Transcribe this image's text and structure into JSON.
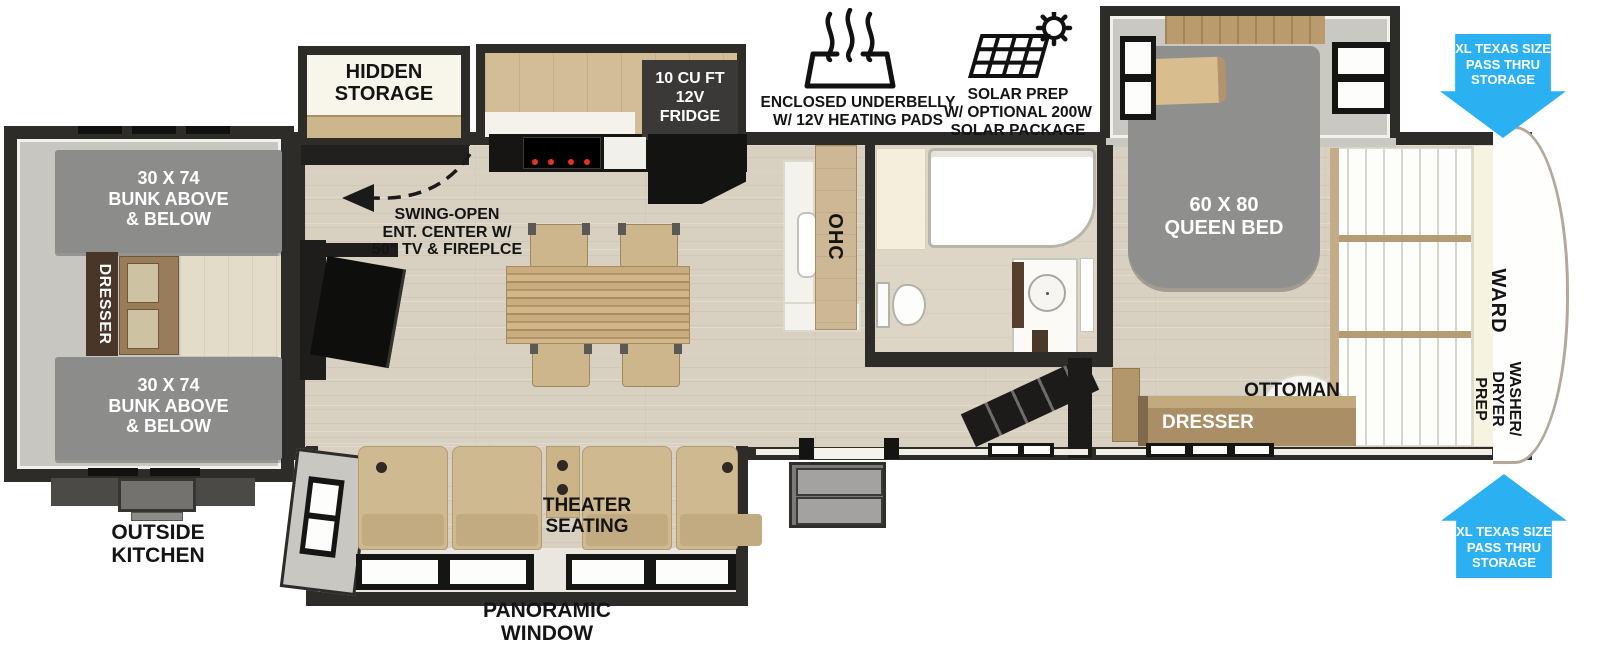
{
  "bunk_room": {
    "top_bunk": "30 X 74\nBUNK ABOVE\n& BELOW",
    "bottom_bunk": "30 X 74\nBUNK ABOVE\n& BELOW",
    "dresser": "DRESSER",
    "outside_kitchen": "OUTSIDE\nKITCHEN"
  },
  "living_area": {
    "hidden_storage": "HIDDEN\nSTORAGE",
    "ent_center_note": "SWING-OPEN\nENT. CENTER W/\n50” TV & FIREPLCE",
    "theater_seating": "THEATER\nSEATING",
    "panoramic_window": "PANORAMIC\nWINDOW"
  },
  "kitchen": {
    "fridge": "10 CU FT\n12V\nFRIDGE",
    "overhead_cabinet": "OHC"
  },
  "bedroom": {
    "queen_bed": "60 X 80\nQUEEN BED",
    "ottoman": "OTTOMAN",
    "dresser": "DRESSER",
    "wardrobe": "WARD",
    "washer_dryer": "WASHER/\nDRYER\nPREP"
  },
  "callouts": {
    "underbelly": "ENCLOSED UNDERBELLY\nW/ 12V HEATING PADS",
    "solar": "SOLAR PREP\nW/ OPTIONAL 200W\nSOLAR PACKAGE"
  },
  "pass_thru": {
    "top": "XL TEXAS SIZE\nPASS THRU\nSTORAGE",
    "bottom": "XL TEXAS SIZE\nPASS THRU\nSTORAGE"
  },
  "colors": {
    "arrow_blue": "#2bb1f1",
    "wall_dark": "#2d2c29",
    "bunk_gray": "#8c8c8b",
    "wood_tan": "#cdb58c",
    "floor_beige": "#d8d1c2",
    "label_black": "#141414"
  }
}
